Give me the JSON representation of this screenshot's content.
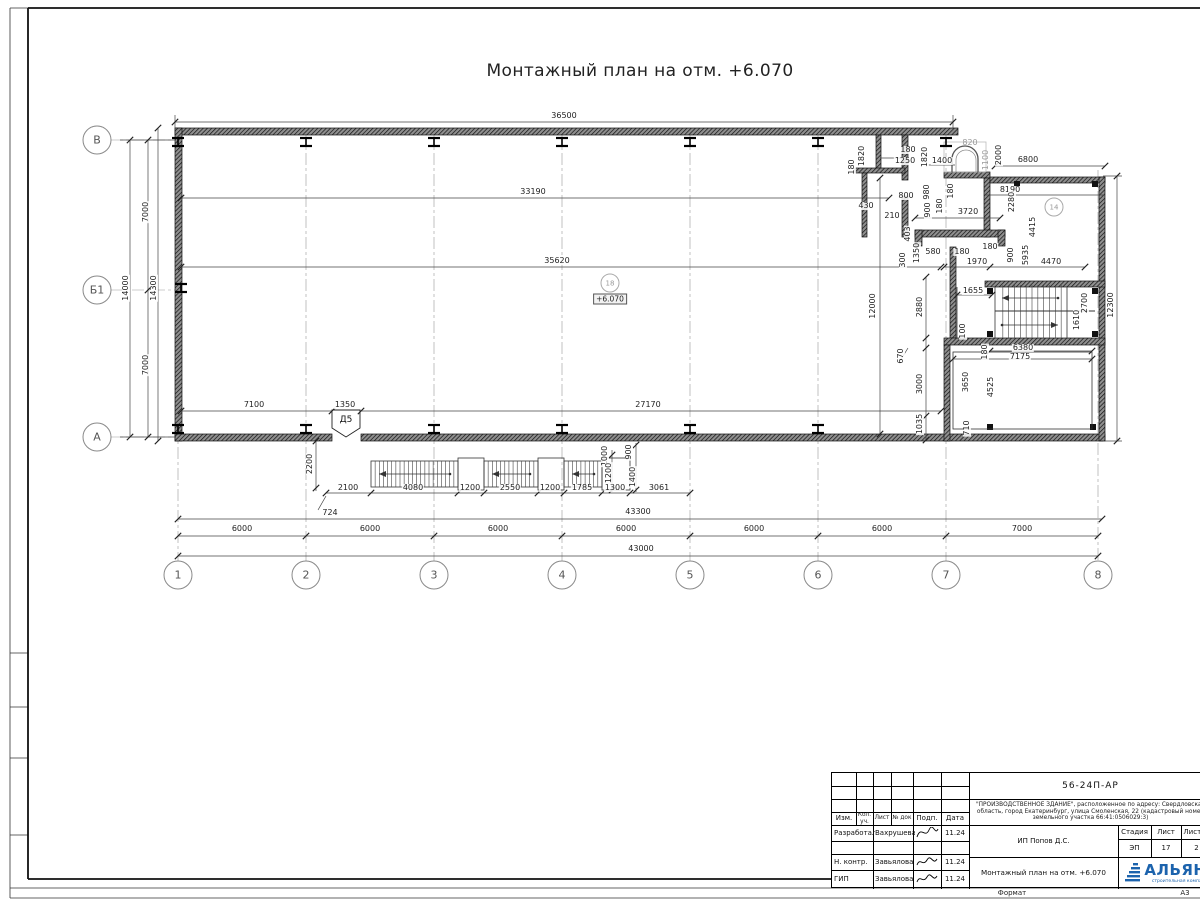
{
  "title": "Монтажный план на отм. +6.070",
  "level_mark": "+6.070",
  "door_marker": "Д5",
  "colors": {
    "line": "#1a1a1a",
    "grey_dim": "#9a9a9a",
    "wall_hatch": "#3a3a3a",
    "logo_blue": "#1c63ad"
  },
  "grid": {
    "col_y": 575,
    "row_x": 97,
    "cols": [
      {
        "label": "1",
        "x": 178
      },
      {
        "label": "2",
        "x": 306
      },
      {
        "label": "3",
        "x": 434
      },
      {
        "label": "4",
        "x": 562
      },
      {
        "label": "5",
        "x": 690
      },
      {
        "label": "6",
        "x": 818
      },
      {
        "label": "7",
        "x": 946
      },
      {
        "label": "8",
        "x": 1098
      }
    ],
    "rows": [
      {
        "label": "В",
        "y": 140
      },
      {
        "label": "Б1",
        "y": 290
      },
      {
        "label": "А",
        "y": 437
      }
    ]
  },
  "rooms": [
    {
      "id": "18",
      "x": 610,
      "y": 283
    },
    {
      "id": "14",
      "x": 1054,
      "y": 207
    }
  ],
  "dims": [
    {
      "t": "36500",
      "x": 564,
      "y": 116
    },
    {
      "t": "33190",
      "x": 533,
      "y": 192
    },
    {
      "t": "35620",
      "x": 557,
      "y": 261
    },
    {
      "t": "7100",
      "x": 254,
      "y": 405
    },
    {
      "t": "1350",
      "x": 345,
      "y": 405
    },
    {
      "t": "27170",
      "x": 648,
      "y": 405
    },
    {
      "t": "2100",
      "x": 348,
      "y": 488
    },
    {
      "t": "4080",
      "x": 413,
      "y": 488
    },
    {
      "t": "1200",
      "x": 470,
      "y": 488
    },
    {
      "t": "2550",
      "x": 510,
      "y": 488
    },
    {
      "t": "1200",
      "x": 550,
      "y": 488
    },
    {
      "t": "1785",
      "x": 582,
      "y": 488
    },
    {
      "t": "1300",
      "x": 615,
      "y": 488
    },
    {
      "t": "3061",
      "x": 659,
      "y": 488
    },
    {
      "t": "724",
      "x": 330,
      "y": 513
    },
    {
      "t": "43300",
      "x": 638,
      "y": 512
    },
    {
      "t": "6000",
      "x": 242,
      "y": 529
    },
    {
      "t": "6000",
      "x": 370,
      "y": 529
    },
    {
      "t": "6000",
      "x": 498,
      "y": 529
    },
    {
      "t": "6000",
      "x": 626,
      "y": 529
    },
    {
      "t": "6000",
      "x": 754,
      "y": 529
    },
    {
      "t": "6000",
      "x": 882,
      "y": 529
    },
    {
      "t": "7000",
      "x": 1022,
      "y": 529
    },
    {
      "t": "43000",
      "x": 641,
      "y": 549
    },
    {
      "t": "2200",
      "x": 310,
      "y": 464,
      "r": 1
    },
    {
      "t": "1000",
      "x": 605,
      "y": 456,
      "r": 1
    },
    {
      "t": "900",
      "x": 629,
      "y": 452,
      "r": 1
    },
    {
      "t": "1200",
      "x": 609,
      "y": 473,
      "r": 1
    },
    {
      "t": "1400",
      "x": 633,
      "y": 477,
      "r": 1
    },
    {
      "t": "7000",
      "x": 146,
      "y": 212,
      "r": 1
    },
    {
      "t": "7000",
      "x": 146,
      "y": 365,
      "r": 1
    },
    {
      "t": "14000",
      "x": 126,
      "y": 288,
      "r": 1
    },
    {
      "t": "14300",
      "x": 154,
      "y": 288,
      "r": 1
    },
    {
      "t": "12300",
      "x": 1111,
      "y": 305,
      "r": 1
    },
    {
      "t": "12000",
      "x": 873,
      "y": 306,
      "r": 1
    },
    {
      "t": "2880",
      "x": 920,
      "y": 307,
      "r": 1
    },
    {
      "t": "670",
      "x": 901,
      "y": 356,
      "r": 1
    },
    {
      "t": "3000",
      "x": 920,
      "y": 384,
      "r": 1
    },
    {
      "t": "1035",
      "x": 920,
      "y": 424,
      "r": 1
    },
    {
      "t": "1820",
      "x": 862,
      "y": 156,
      "r": 1
    },
    {
      "t": "180",
      "x": 852,
      "y": 167,
      "r": 1
    },
    {
      "t": "180",
      "x": 908,
      "y": 150
    },
    {
      "t": "1250",
      "x": 905,
      "y": 161
    },
    {
      "t": "1820",
      "x": 925,
      "y": 157,
      "r": 1
    },
    {
      "t": "1400",
      "x": 942,
      "y": 161
    },
    {
      "t": "820",
      "x": 970,
      "y": 143,
      "g": 1
    },
    {
      "t": "1100",
      "x": 986,
      "y": 160,
      "r": 1,
      "g": 1
    },
    {
      "t": "2000",
      "x": 999,
      "y": 155,
      "r": 1
    },
    {
      "t": "6800",
      "x": 1028,
      "y": 160
    },
    {
      "t": "430",
      "x": 866,
      "y": 206
    },
    {
      "t": "800",
      "x": 906,
      "y": 196
    },
    {
      "t": "210",
      "x": 892,
      "y": 216
    },
    {
      "t": "980",
      "x": 927,
      "y": 192,
      "r": 1
    },
    {
      "t": "180",
      "x": 951,
      "y": 191,
      "r": 1
    },
    {
      "t": "900",
      "x": 928,
      "y": 210,
      "r": 1
    },
    {
      "t": "180",
      "x": 940,
      "y": 206,
      "r": 1
    },
    {
      "t": "3720",
      "x": 968,
      "y": 212
    },
    {
      "t": "8190",
      "x": 1010,
      "y": 190
    },
    {
      "t": "2280",
      "x": 1012,
      "y": 202,
      "r": 1
    },
    {
      "t": "403",
      "x": 908,
      "y": 234,
      "r": 1
    },
    {
      "t": "300",
      "x": 903,
      "y": 260,
      "r": 1
    },
    {
      "t": "1350",
      "x": 917,
      "y": 253,
      "r": 1
    },
    {
      "t": "580",
      "x": 933,
      "y": 252
    },
    {
      "t": "180",
      "x": 962,
      "y": 252
    },
    {
      "t": "1970",
      "x": 977,
      "y": 262
    },
    {
      "t": "180",
      "x": 990,
      "y": 247
    },
    {
      "t": "900",
      "x": 1011,
      "y": 255,
      "r": 1
    },
    {
      "t": "5935",
      "x": 1026,
      "y": 255,
      "r": 1
    },
    {
      "t": "4415",
      "x": 1033,
      "y": 227,
      "r": 1
    },
    {
      "t": "4470",
      "x": 1051,
      "y": 262
    },
    {
      "t": "1655",
      "x": 973,
      "y": 291
    },
    {
      "t": "2700",
      "x": 1085,
      "y": 303,
      "r": 1
    },
    {
      "t": "1610",
      "x": 1077,
      "y": 320,
      "r": 1
    },
    {
      "t": "100",
      "x": 963,
      "y": 331,
      "r": 1
    },
    {
      "t": "180",
      "x": 985,
      "y": 352,
      "r": 1
    },
    {
      "t": "6380",
      "x": 1023,
      "y": 348
    },
    {
      "t": "7175",
      "x": 1020,
      "y": 357
    },
    {
      "t": "3650",
      "x": 966,
      "y": 382,
      "r": 1
    },
    {
      "t": "4525",
      "x": 991,
      "y": 387,
      "r": 1
    },
    {
      "t": "710",
      "x": 967,
      "y": 428,
      "r": 1
    }
  ],
  "titleblock": {
    "doc_code": "56-24П-АР",
    "project": "\"ПРОИЗВОДСТВЕННОЕ ЗДАНИЕ\", расположенное по адресу: Свердловская область, город Екатеринбург, улица Смоленская, 22 (кадастровый номер земельного участка 66:41:0506029:3)",
    "client": "ИП Попов Д.С.",
    "drawing_title": "Монтажный план на отм. +6.070",
    "cols": [
      "Изм.",
      "Кол. уч.",
      "Лист",
      "№ док",
      "Подп.",
      "Дата"
    ],
    "rows": [
      {
        "role": "Разработал",
        "name": "Вахрушева",
        "date": "11.24"
      },
      {
        "role": "Н. контр.",
        "name": "Завьялова",
        "date": "11.24"
      },
      {
        "role": "ГИП",
        "name": "Завьялова",
        "date": "11.24"
      }
    ],
    "stage_label": "Стадия",
    "stage": "ЭП",
    "sheet_label": "Лист",
    "sheet": "17",
    "sheets_label": "Листов",
    "sheets": "2",
    "logo_text": "АЛЬЯНС",
    "logo_sub": "строительная компания",
    "format_label": "Формат",
    "format": "А3"
  }
}
